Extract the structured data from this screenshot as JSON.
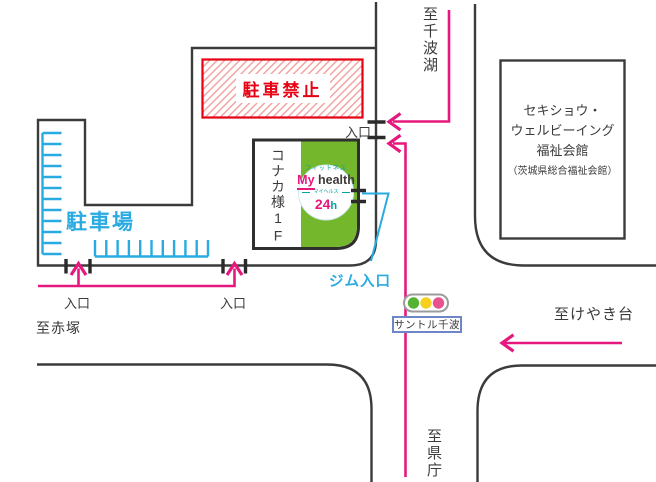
{
  "map": {
    "title_hint": "gym access map",
    "labels": {
      "to_senba_lake": "至千波湖",
      "entrance": "入口",
      "no_parking": "駐車禁止",
      "welfare_hall_line1": "セキショウ・",
      "welfare_hall_line2": "ウェルビーイング",
      "welfare_hall_line3": "福祉会館",
      "welfare_hall_sub": "（茨城県総合福祉会館）",
      "konaka_tenant": "コナカ様1F",
      "parking_lot": "駐車場",
      "gym_entrance": "ジム入口",
      "to_akatsuka": "至赤塚",
      "intersection_name": "サントル千波",
      "to_keyakidai": "至けやき台",
      "to_kencho": "至県庁"
    },
    "logo": {
      "fitness": "フィットネス",
      "brand_my": "My",
      "brand_health": "health",
      "reading": "マイヘルス",
      "hours_num": "24",
      "hours_unit": "h"
    },
    "colors": {
      "route_pink": "#e7187d",
      "parking_blue": "#29abe2",
      "building_green": "#74b62c",
      "warning_red": "#e60012",
      "road_gray": "#3b3b3b",
      "logo_teal": "#00a5a0",
      "signal_green": "#54b332",
      "signal_yellow": "#f5d021",
      "signal_red": "#e8538f",
      "label_box_border": "#6e86c8"
    }
  }
}
